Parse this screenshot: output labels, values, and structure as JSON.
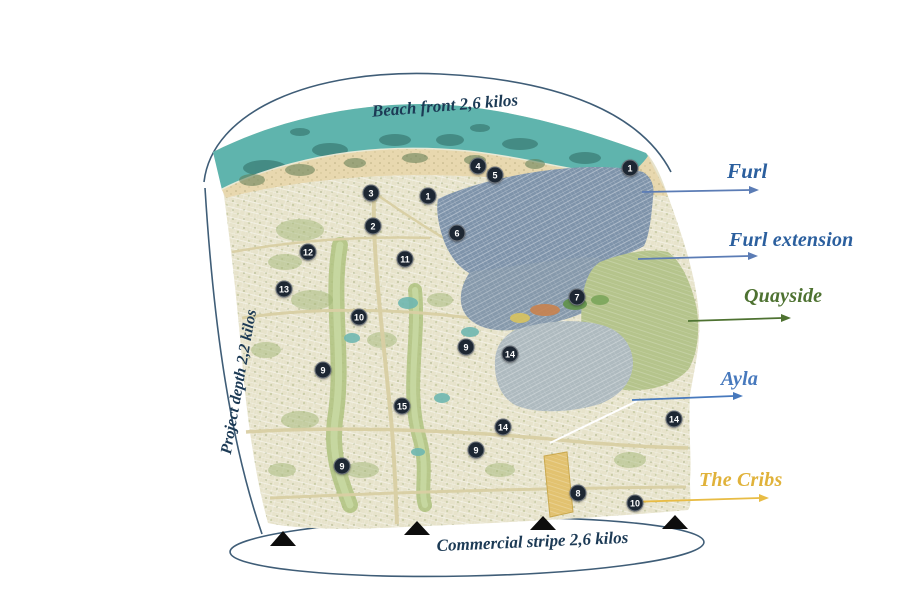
{
  "boundaries": {
    "beach_front": "Beach front 2,6 kilos",
    "project_depth": "Project depth 2,2 kilos",
    "commercial_stripe": "Commercial stripe 2,6 kilos",
    "text_color": "#1c3a55"
  },
  "districts": [
    {
      "name": "Furl",
      "label_color": "#2b5f9e",
      "arrow_color": "#5b7cb5",
      "region_color": "#7e93aa"
    },
    {
      "name": "Furl extension",
      "label_color": "#2b5f9e",
      "arrow_color": "#5b7cb5",
      "region_color": "#8699ab"
    },
    {
      "name": "Quayside",
      "label_color": "#4e7231",
      "arrow_color": "#4e7231",
      "region_color": "#b5c48c"
    },
    {
      "name": "Ayla",
      "label_color": "#4779bd",
      "arrow_color": "#4779bd",
      "region_color": "#aebabf"
    },
    {
      "name": "The Cribs",
      "label_color": "#e0b23a",
      "arrow_color": "#e8bc45",
      "region_color": "#e2c270"
    }
  ],
  "markers": [
    {
      "label": "3",
      "x": 371,
      "y": 193
    },
    {
      "label": "1",
      "x": 428,
      "y": 196
    },
    {
      "label": "2",
      "x": 373,
      "y": 226
    },
    {
      "label": "4",
      "x": 478,
      "y": 166
    },
    {
      "label": "5",
      "x": 495,
      "y": 175
    },
    {
      "label": "1",
      "x": 630,
      "y": 168
    },
    {
      "label": "6",
      "x": 457,
      "y": 233
    },
    {
      "label": "12",
      "x": 308,
      "y": 252
    },
    {
      "label": "11",
      "x": 405,
      "y": 259
    },
    {
      "label": "13",
      "x": 284,
      "y": 289
    },
    {
      "label": "10",
      "x": 359,
      "y": 317
    },
    {
      "label": "7",
      "x": 577,
      "y": 297
    },
    {
      "label": "9",
      "x": 466,
      "y": 347
    },
    {
      "label": "14",
      "x": 510,
      "y": 354
    },
    {
      "label": "9",
      "x": 323,
      "y": 370
    },
    {
      "label": "15",
      "x": 402,
      "y": 406
    },
    {
      "label": "14",
      "x": 503,
      "y": 427
    },
    {
      "label": "14",
      "x": 674,
      "y": 419
    },
    {
      "label": "9",
      "x": 476,
      "y": 450
    },
    {
      "label": "9",
      "x": 342,
      "y": 466
    },
    {
      "label": "8",
      "x": 578,
      "y": 493
    },
    {
      "label": "10",
      "x": 635,
      "y": 503
    }
  ],
  "palette": {
    "sea": "#5fb4ad",
    "sand": "#e8d8af",
    "land": "#e7e3cb",
    "arc": "#3f5d77",
    "marker_bg": "#1d2733",
    "marker_text": "#ffffff",
    "triangle": "#0d0d0d",
    "surf": "#f7f0dc"
  }
}
